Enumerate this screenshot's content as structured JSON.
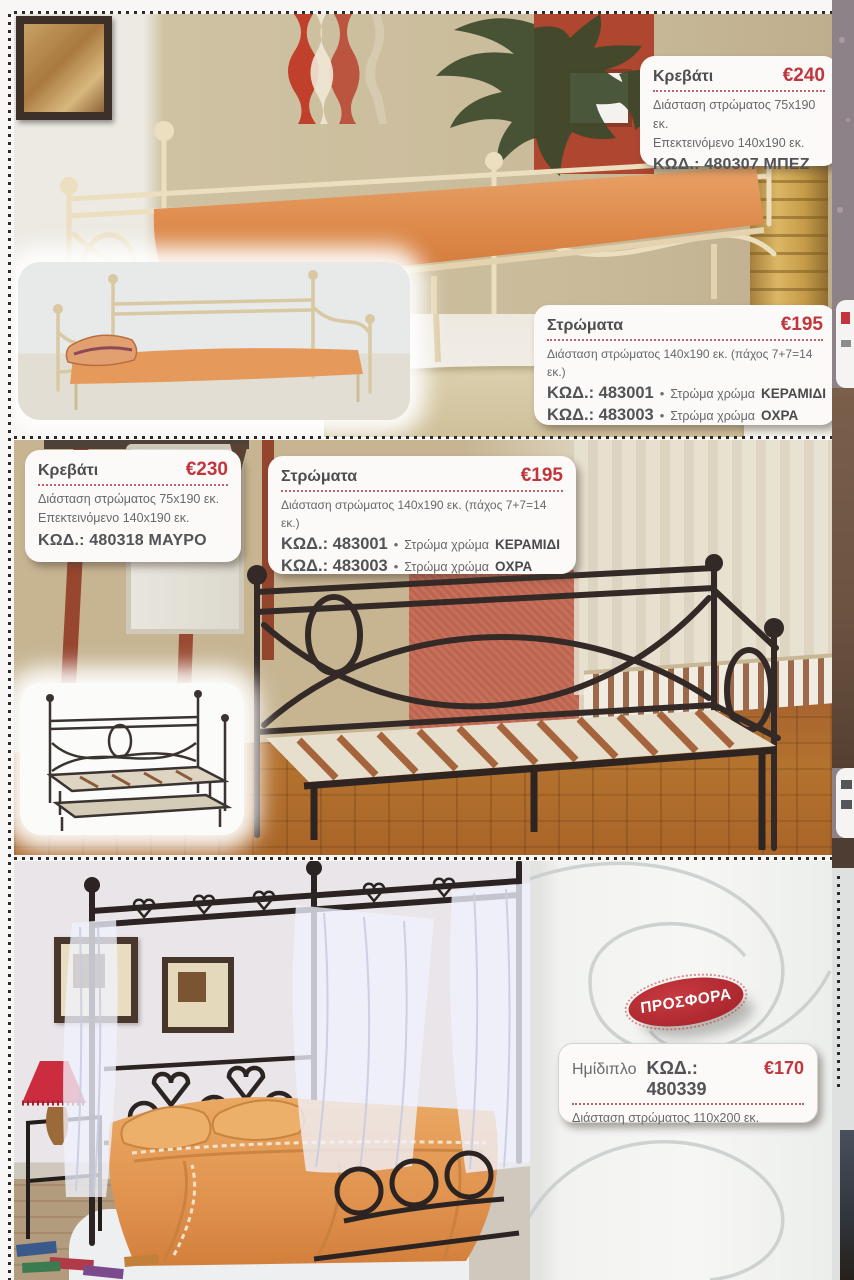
{
  "catalog_page": {
    "top_section": {
      "bed_box": {
        "title": "Κρεβάτι",
        "price": "€240",
        "dim1": "Διάσταση στρώματος 75x190 εκ.",
        "dim2": "Επεκτεινόμενο 140x190 εκ.",
        "code_line": "ΚΩΔ.: 480307 ΜΠΕΖ"
      },
      "mattress_box": {
        "title": "Στρώματα",
        "price": "€195",
        "dim": "Διάσταση στρώματος 140x190 εκ. (πάχος 7+7=14 εκ.)",
        "row1": {
          "code": "ΚΩΔ.: 483001",
          "bullet": "•",
          "text": "Στρώμα χρώμα",
          "color_name": "ΚΕΡΑΜΙΔΙ"
        },
        "row2": {
          "code": "ΚΩΔ.: 483003",
          "bullet": "•",
          "text": "Στρώμα χρώμα",
          "color_name": "ΟΧΡΑ"
        }
      }
    },
    "middle_section": {
      "bed_box": {
        "title": "Κρεβάτι",
        "price": "€230",
        "dim1": "Διάσταση στρώματος 75x190 εκ.",
        "dim2": "Επεκτεινόμενο 140x190 εκ.",
        "code_line": "ΚΩΔ.: 480318 ΜΑΥΡΟ"
      },
      "mattress_box": {
        "title": "Στρώματα",
        "price": "€195",
        "dim": "Διάσταση στρώματος 140x190 εκ. (πάχος 7+7=14 εκ.)",
        "row1": {
          "code": "ΚΩΔ.: 483001",
          "bullet": "•",
          "text": "Στρώμα χρώμα",
          "color_name": "ΚΕΡΑΜΙΔΙ"
        },
        "row2": {
          "code": "ΚΩΔ.: 483003",
          "bullet": "•",
          "text": "Στρώμα χρώμα",
          "color_name": "ΟΧΡΑ"
        }
      }
    },
    "bottom_section": {
      "offer_badge": "ΠΡΟΣΦΟΡΑ",
      "offer_box": {
        "name": "Ημίδιπλο",
        "code": "ΚΩΔ.: 480339",
        "price": "€170",
        "dim": "Διάσταση στρώματος 110x200 εκ."
      }
    },
    "colors": {
      "price_red": "#c2353d",
      "badge_red": "#b92f34",
      "text_dark": "#4e4e50",
      "text_body": "#67686b",
      "box_bg": "#fbfaf8"
    }
  }
}
